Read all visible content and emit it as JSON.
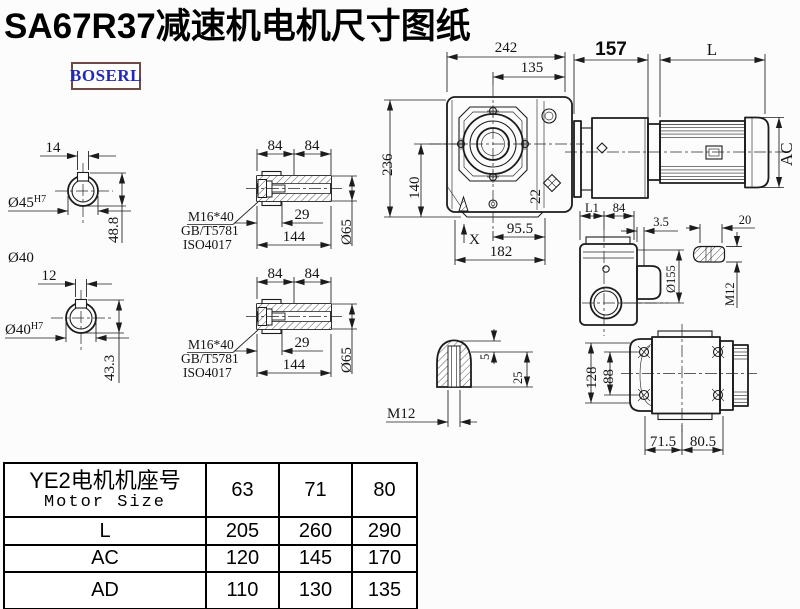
{
  "title": "SA67R37减速机电机尺寸图纸",
  "logo": "BOSERL",
  "colors": {
    "line": "#1c1c1c",
    "logo_text": "#2228bb",
    "logo_border": "#6d4a47",
    "background": "#fcfcfc"
  },
  "views": {
    "shaft_section_1": {
      "keyway_width": "14",
      "bore": "Ø45",
      "bore_tol": "H7",
      "height": "48.8",
      "outer_dia": "Ø40"
    },
    "shaft_section_2": {
      "keyway_width": "12",
      "bore": "Ø40",
      "bore_tol": "H7",
      "height": "43.3"
    },
    "hollow_shaft_1": {
      "len_a": "84",
      "len_b": "84",
      "bolt": "M16*40",
      "std_1": "GB/T5781",
      "std_2": "ISO4017",
      "depth": "29",
      "length": "144",
      "dia": "Ø65"
    },
    "hollow_shaft_2": {
      "len_a": "84",
      "len_b": "84",
      "bolt": "M16*40",
      "std_1": "GB/T5781",
      "std_2": "ISO4017",
      "depth": "29",
      "length": "144",
      "dia": "Ø65"
    },
    "front": {
      "width": "242",
      "center_to_flange": "135",
      "height": "236",
      "center_height": "140",
      "plug": "22",
      "center_to_foot": "95.5",
      "foot_span": "182",
      "x_mark": "X"
    },
    "side": {
      "gear_unit_length": "157",
      "motor_length": "L",
      "motor_dia": "AC"
    },
    "rear": {
      "len_l1": "L1",
      "len_84": "84",
      "flange_thk": "3.5",
      "key_len": "20",
      "flange_dia": "Ø155",
      "thread": "M12"
    },
    "key_detail": {
      "key_height": "5",
      "key_depth": "25",
      "thread": "M12"
    },
    "bottom": {
      "height": "128",
      "bolt_span": "88",
      "foot_a": "71.5",
      "foot_b": "80.5"
    }
  },
  "table": {
    "header_cn": "YE2电机机座号",
    "header_en": "Motor Size",
    "sizes": [
      "63",
      "71",
      "80"
    ],
    "rows": [
      {
        "label": "L",
        "values": [
          "205",
          "260",
          "290"
        ]
      },
      {
        "label": "AC",
        "values": [
          "120",
          "145",
          "170"
        ]
      },
      {
        "label": "AD",
        "values": [
          "110",
          "130",
          "135"
        ]
      }
    ]
  }
}
